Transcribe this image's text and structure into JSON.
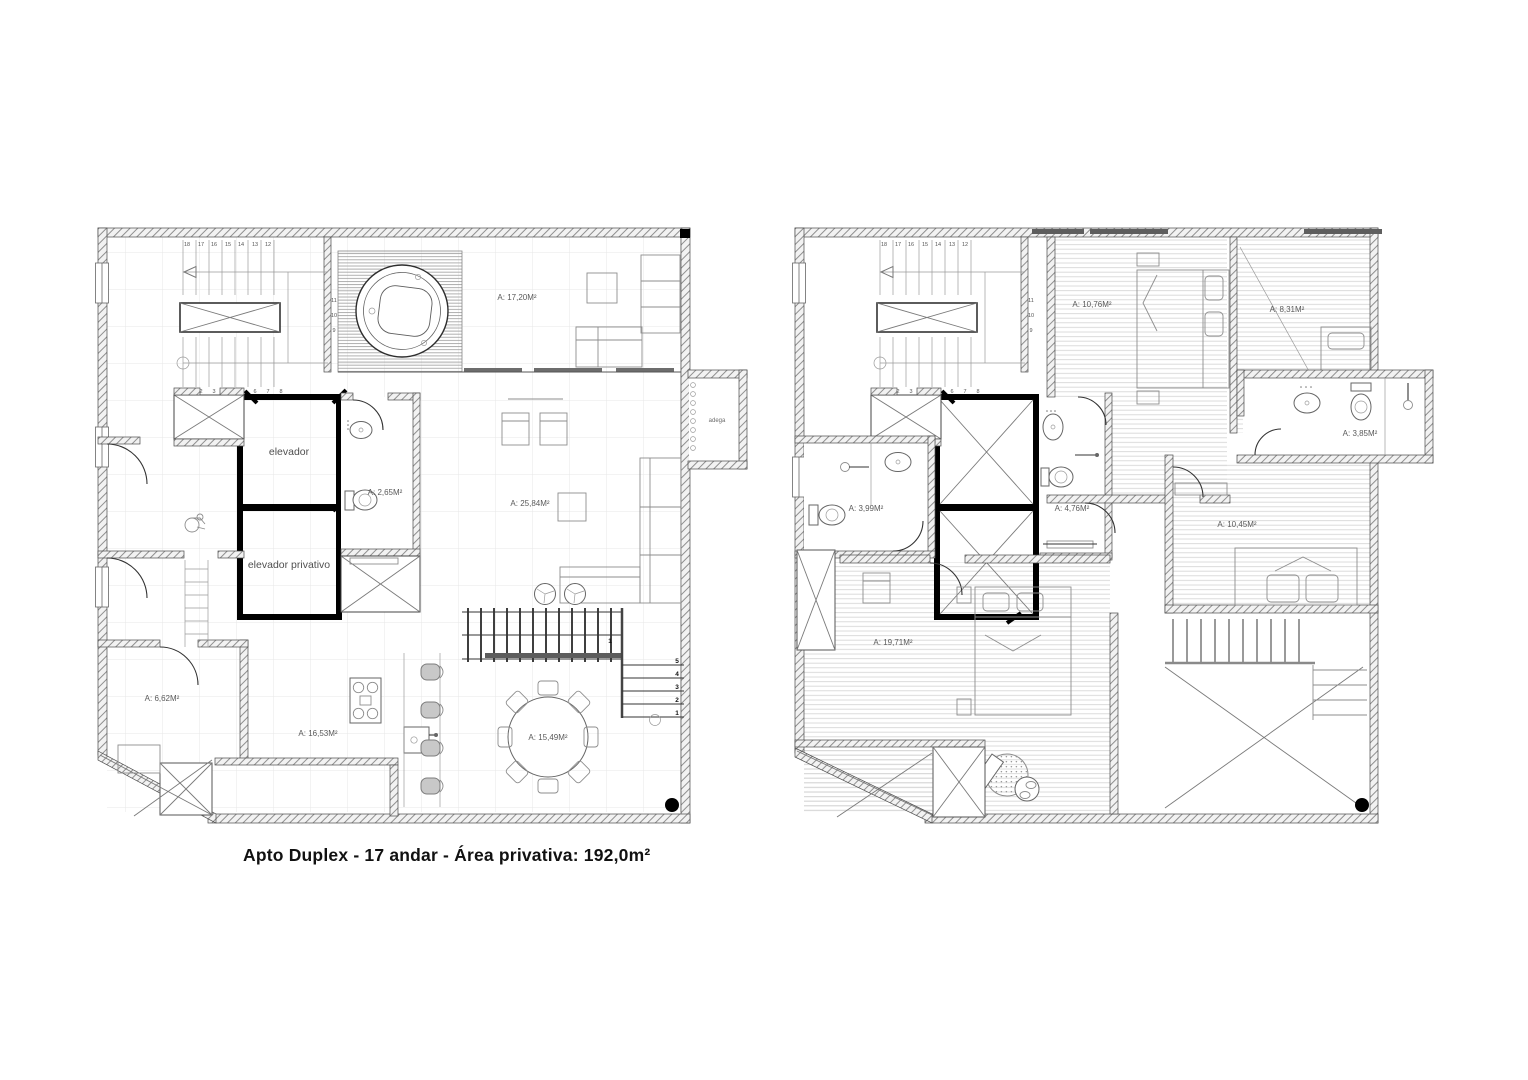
{
  "caption": "Apto Duplex - 17 andar  - Área privativa: 192,0m²",
  "floor_lower": {
    "rooms": {
      "terrace": "A: 17,20M²",
      "living": "A: 25,84M²",
      "lavabo": "A: 2,65M²",
      "kitchen": "A: 16,53M²",
      "dining": "A: 15,49M²",
      "hall": "A: 6,62M²",
      "adega": "adega",
      "elevator": "elevador",
      "private_elevator": "elevador privativo"
    },
    "stairs": {
      "upper_run": [
        "18",
        "17",
        "16",
        "15",
        "14",
        "13",
        "12"
      ],
      "mid_run": [
        "11",
        "10",
        "9"
      ],
      "lower_run": [
        "1",
        "2",
        "3",
        "4",
        "5",
        "6",
        "7",
        "8"
      ],
      "internal_steps": [
        "5",
        "4",
        "3",
        "2",
        "1"
      ],
      "internal_start": "1"
    }
  },
  "floor_upper": {
    "rooms": {
      "bedroom_1": "A: 10,76M²",
      "bedroom_2": "A: 8,31M²",
      "bath_1": "A: 3,85M²",
      "bath_2": "A: 4,76M²",
      "bath_3": "A: 3,99M²",
      "bedroom_3": "A: 10,45M²",
      "master_suite": "A: 19,71M²"
    },
    "stairs": {
      "upper_run": [
        "18",
        "17",
        "16",
        "15",
        "14",
        "13",
        "12"
      ],
      "mid_run": [
        "11",
        "10",
        "9"
      ],
      "lower_run": [
        "1",
        "2",
        "3",
        "4",
        "5",
        "6",
        "7",
        "8"
      ]
    }
  }
}
